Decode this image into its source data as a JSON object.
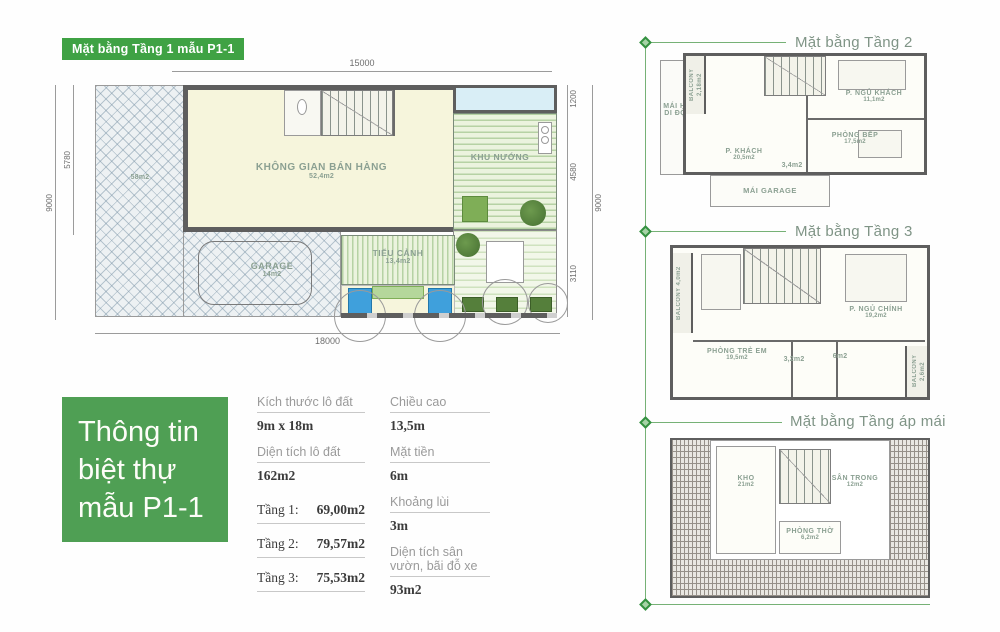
{
  "colors": {
    "brand_green": "#3fa244",
    "box_green": "#4f9f54",
    "connector_green": "#76b176",
    "room_label": "#8ba092",
    "plan_title": "#7f9486",
    "water_blue": "#3fa0dc",
    "interior_cream": "#f6f5dc",
    "blue_room": "#d9eef6"
  },
  "floor1": {
    "badge": "Mặt bằng Tầng 1 mẫu P1-1",
    "rooms": {
      "sales": {
        "name": "KHÔNG GIAN BÁN HÀNG",
        "area": "52,4m2"
      },
      "khu_nuong": {
        "name": "KHU NƯỚNG"
      },
      "tieu_canh": {
        "name": "TIỂU CẢNH",
        "area": "13,4m2"
      },
      "garage": {
        "name": "GARAGE",
        "area": "14m2"
      },
      "yard": {
        "area": "58m2"
      }
    },
    "dims": {
      "top": "15000",
      "bottom": "18000",
      "left_outer": "9000",
      "left_inner": "5780",
      "right_top": "1200",
      "right_mid": "4580",
      "right_low": "3110",
      "right_outer": "9000"
    }
  },
  "info_box": {
    "line1": "Thông tin",
    "line2": "biệt thự",
    "line3": "mẫu P1-1"
  },
  "specs": {
    "col1": [
      {
        "label": "Kích thước lô đất",
        "value": "9m x 18m"
      },
      {
        "label": "Diện tích lô đất",
        "value": "162m2"
      },
      {
        "label": "Tầng 1:",
        "value": "69,00m2"
      },
      {
        "label": "Tầng 2:",
        "value": "79,57m2"
      },
      {
        "label": "Tầng 3:",
        "value": "75,53m2"
      }
    ],
    "col2": [
      {
        "label": "Chiều cao",
        "value": "13,5m"
      },
      {
        "label": "Mặt tiền",
        "value": "6m"
      },
      {
        "label": "Khoảng lùi",
        "value": "3m"
      },
      {
        "label": "Diện tích sân vườn, bãi đỗ xe",
        "value": "93m2"
      }
    ]
  },
  "floor2": {
    "title": "Mặt bằng Tầng 2",
    "rooms": {
      "balcony": {
        "name": "BALCONY",
        "area": "2,18m2"
      },
      "mai_hien": {
        "line1": "MÁI HIÊN",
        "line2": "DI ĐỘNG"
      },
      "p_khach": {
        "name": "P. KHÁCH",
        "area": "20,5m2"
      },
      "p_ngu_khach": {
        "name": "P. NGỦ KHÁCH",
        "area": "11,1m2"
      },
      "phong_bep": {
        "name": "PHÒNG BẾP",
        "area": "17,5m2"
      },
      "wc": {
        "area": "3,4m2"
      },
      "mai_garage": {
        "name": "MÁI GARAGE"
      }
    }
  },
  "floor3": {
    "title": "Mặt bằng Tầng 3",
    "rooms": {
      "balcony_left": {
        "name": "BALCONY",
        "area": "4,0m2"
      },
      "phong_tre_em": {
        "name": "PHÒNG TRẺ EM",
        "area": "19,5m2"
      },
      "p_ngu_chinh": {
        "name": "P. NGỦ CHÍNH",
        "area": "19,2m2"
      },
      "wc": {
        "area": "3,2m2"
      },
      "bath": {
        "area": "6m2"
      },
      "balcony_right": {
        "name": "BALCONY",
        "area": "2,6m2"
      }
    }
  },
  "attic": {
    "title": "Mặt bằng Tầng áp mái",
    "rooms": {
      "kho": {
        "name": "KHO",
        "area": "21m2"
      },
      "san_trong": {
        "name": "SÂN TRONG",
        "area": "12m2"
      },
      "phong_tho": {
        "name": "PHÒNG THỜ",
        "area": "6,2m2"
      }
    }
  }
}
